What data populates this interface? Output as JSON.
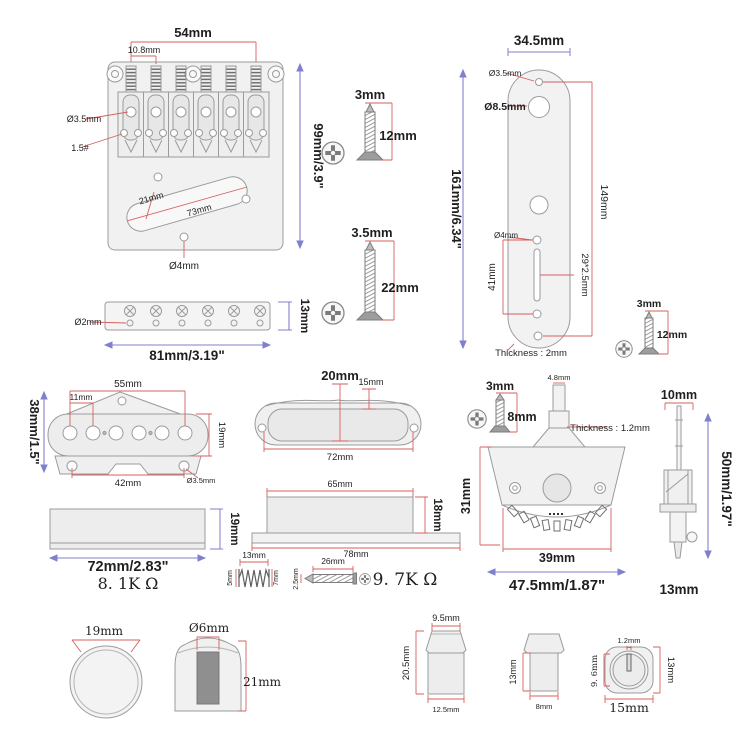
{
  "palette": {
    "red": "#d4605e",
    "blue": "#8080cc",
    "ink": "#1f1f1f",
    "outline": "#9b9b9b",
    "fill": "#f1f1f1"
  },
  "bridge": {
    "overall": "54mm",
    "spacing": "10.8mm",
    "saddle_hole": "Ø3.5mm",
    "saddle_screw": "1.5#",
    "length": "99mm/3.9\"",
    "slot_width": "21mm",
    "slot_length": "73mm",
    "mount_hole": "Ø4mm"
  },
  "ferrules": {
    "hole": "Ø2mm",
    "width": "81mm/3.19\"",
    "height": "13mm"
  },
  "screw_a": {
    "d": "3mm",
    "l": "12mm"
  },
  "screw_b": {
    "d": "3.5mm",
    "l": "22mm"
  },
  "plate": {
    "width": "34.5mm",
    "small_hole": "Ø3.5mm",
    "pot_hole": "Ø8.5mm",
    "span": "149mm",
    "length": "161mm/6.34\"",
    "hole": "Ø4mm",
    "slot_span": "41mm",
    "slot": "29*2.5mm",
    "thickness": "Thickness : 2mm"
  },
  "screw_c": {
    "d": "3mm",
    "l": "12mm"
  },
  "pickup_bridge": {
    "width": "55mm",
    "spacing": "11mm",
    "height": "38mm/1.5\"",
    "bobbin": "19mm",
    "mount_span": "42mm",
    "mount_hole": "Ø3.5mm"
  },
  "pickup_neck": {
    "height": "20mm",
    "cover": "15mm",
    "width": "72mm"
  },
  "side_left": {
    "height": "19mm",
    "width": "72mm/2.83\"",
    "resistance": "8. 1K Ω"
  },
  "side_mid": {
    "top": "65mm",
    "height": "18mm",
    "base": "78mm",
    "resistance": "9. 7K Ω"
  },
  "spring": {
    "len": "13mm",
    "d_left": "5mm",
    "d_right": "7mm"
  },
  "screw_d": {
    "d": "2.5mm",
    "l": "26mm"
  },
  "switch": {
    "screw_d": "3mm",
    "screw_l": "8mm",
    "tip": "4.8mm",
    "thickness": "Thickness : 1.2mm",
    "height": "31mm",
    "width": "39mm",
    "overall": "47.5mm/1.87\""
  },
  "switch_side": {
    "width": "10mm",
    "height": "50mm/1.97\"",
    "depth": "13mm"
  },
  "knob_top": {
    "diameter": "19mm"
  },
  "knob_side": {
    "shaft": "Ø6mm",
    "height": "21mm"
  },
  "tip1": {
    "top": "9.5mm",
    "height": "20.5mm",
    "base": "12.5mm"
  },
  "tip2": {
    "height": "13mm",
    "base": "8mm"
  },
  "tip_top": {
    "slot": "1.2mm",
    "inner": "9. 6mm",
    "height": "13mm",
    "width": "15mm"
  }
}
